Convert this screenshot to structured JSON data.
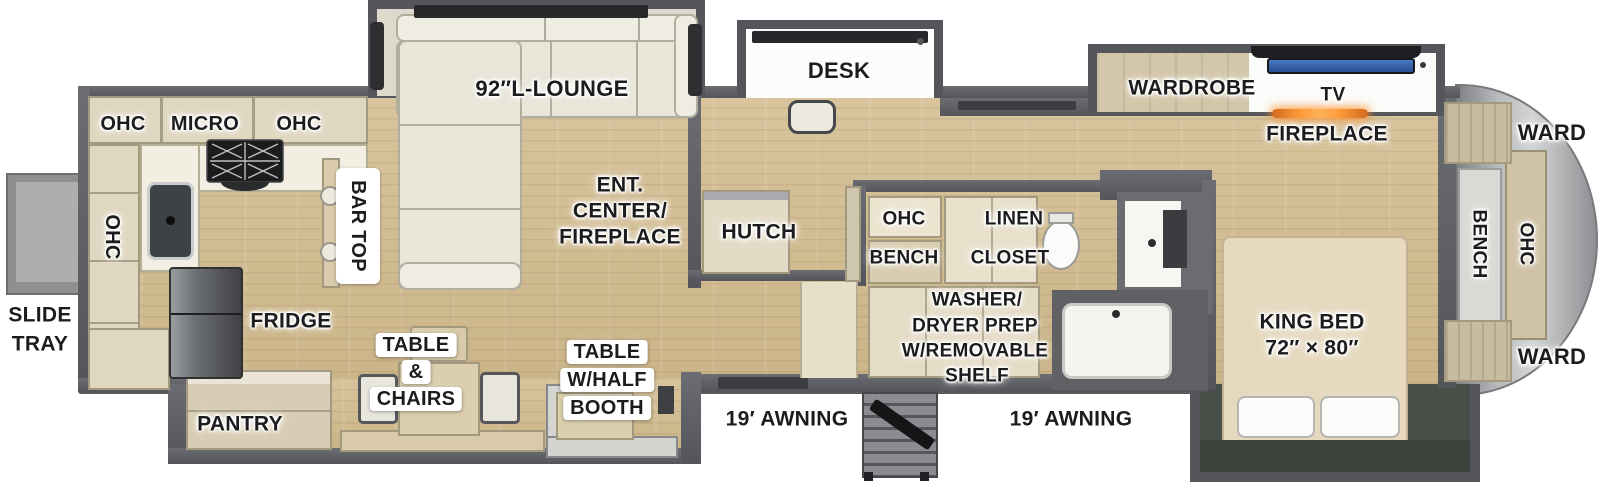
{
  "colors": {
    "wall_gray": "#5a5c61",
    "floor_wood": "#d2bd93",
    "cabinet_cream": "#e0d7c1",
    "sofa_cream": "#e8e5d9",
    "tv_screen_blue": "#3a6cb8",
    "fireplace_glow_orange": "#ff8a2a",
    "fridge_stainless": "#55585b",
    "front_cap_silver": "#b9bbbd",
    "bed_slide_interior": "#4a4e48",
    "label_text": "#1c1c1e"
  },
  "exterior": {
    "slide_tray": [
      "SLIDE",
      "TRAY"
    ],
    "awning_left": "19′ AWNING",
    "awning_right": "19′ AWNING"
  },
  "kitchen": {
    "ohc_upper_left": "OHC",
    "micro": "MICRO",
    "ohc_upper_right": "OHC",
    "ohc_side": "OHC",
    "bar_top": "BAR TOP",
    "fridge": "FRIDGE",
    "pantry": "PANTRY"
  },
  "living": {
    "lounge": "92″L-LOUNGE",
    "ent_center": [
      "ENT.",
      "CENTER/",
      "FIREPLACE"
    ],
    "hutch": "HUTCH",
    "desk": "DESK",
    "dinette": [
      "TABLE",
      "&",
      "CHAIRS"
    ],
    "booth_dinette": [
      "TABLE",
      "W/HALF",
      "BOOTH"
    ]
  },
  "bath": {
    "ohc": "OHC",
    "bench": "BENCH",
    "linen_closet": [
      "LINEN",
      "CLOSET"
    ],
    "washer_prep": [
      "WASHER/",
      "DRYER PREP",
      "W/REMOVABLE",
      "SHELF"
    ]
  },
  "bedroom": {
    "wardrobe": "WARDROBE",
    "tv": "TV",
    "fireplace": "FIREPLACE",
    "king_bed": [
      "KING BED",
      "72″ × 80″"
    ],
    "ward_top": "WARD",
    "ward_bottom": "WARD",
    "ohc": "OHC",
    "bench": "BENCH"
  }
}
